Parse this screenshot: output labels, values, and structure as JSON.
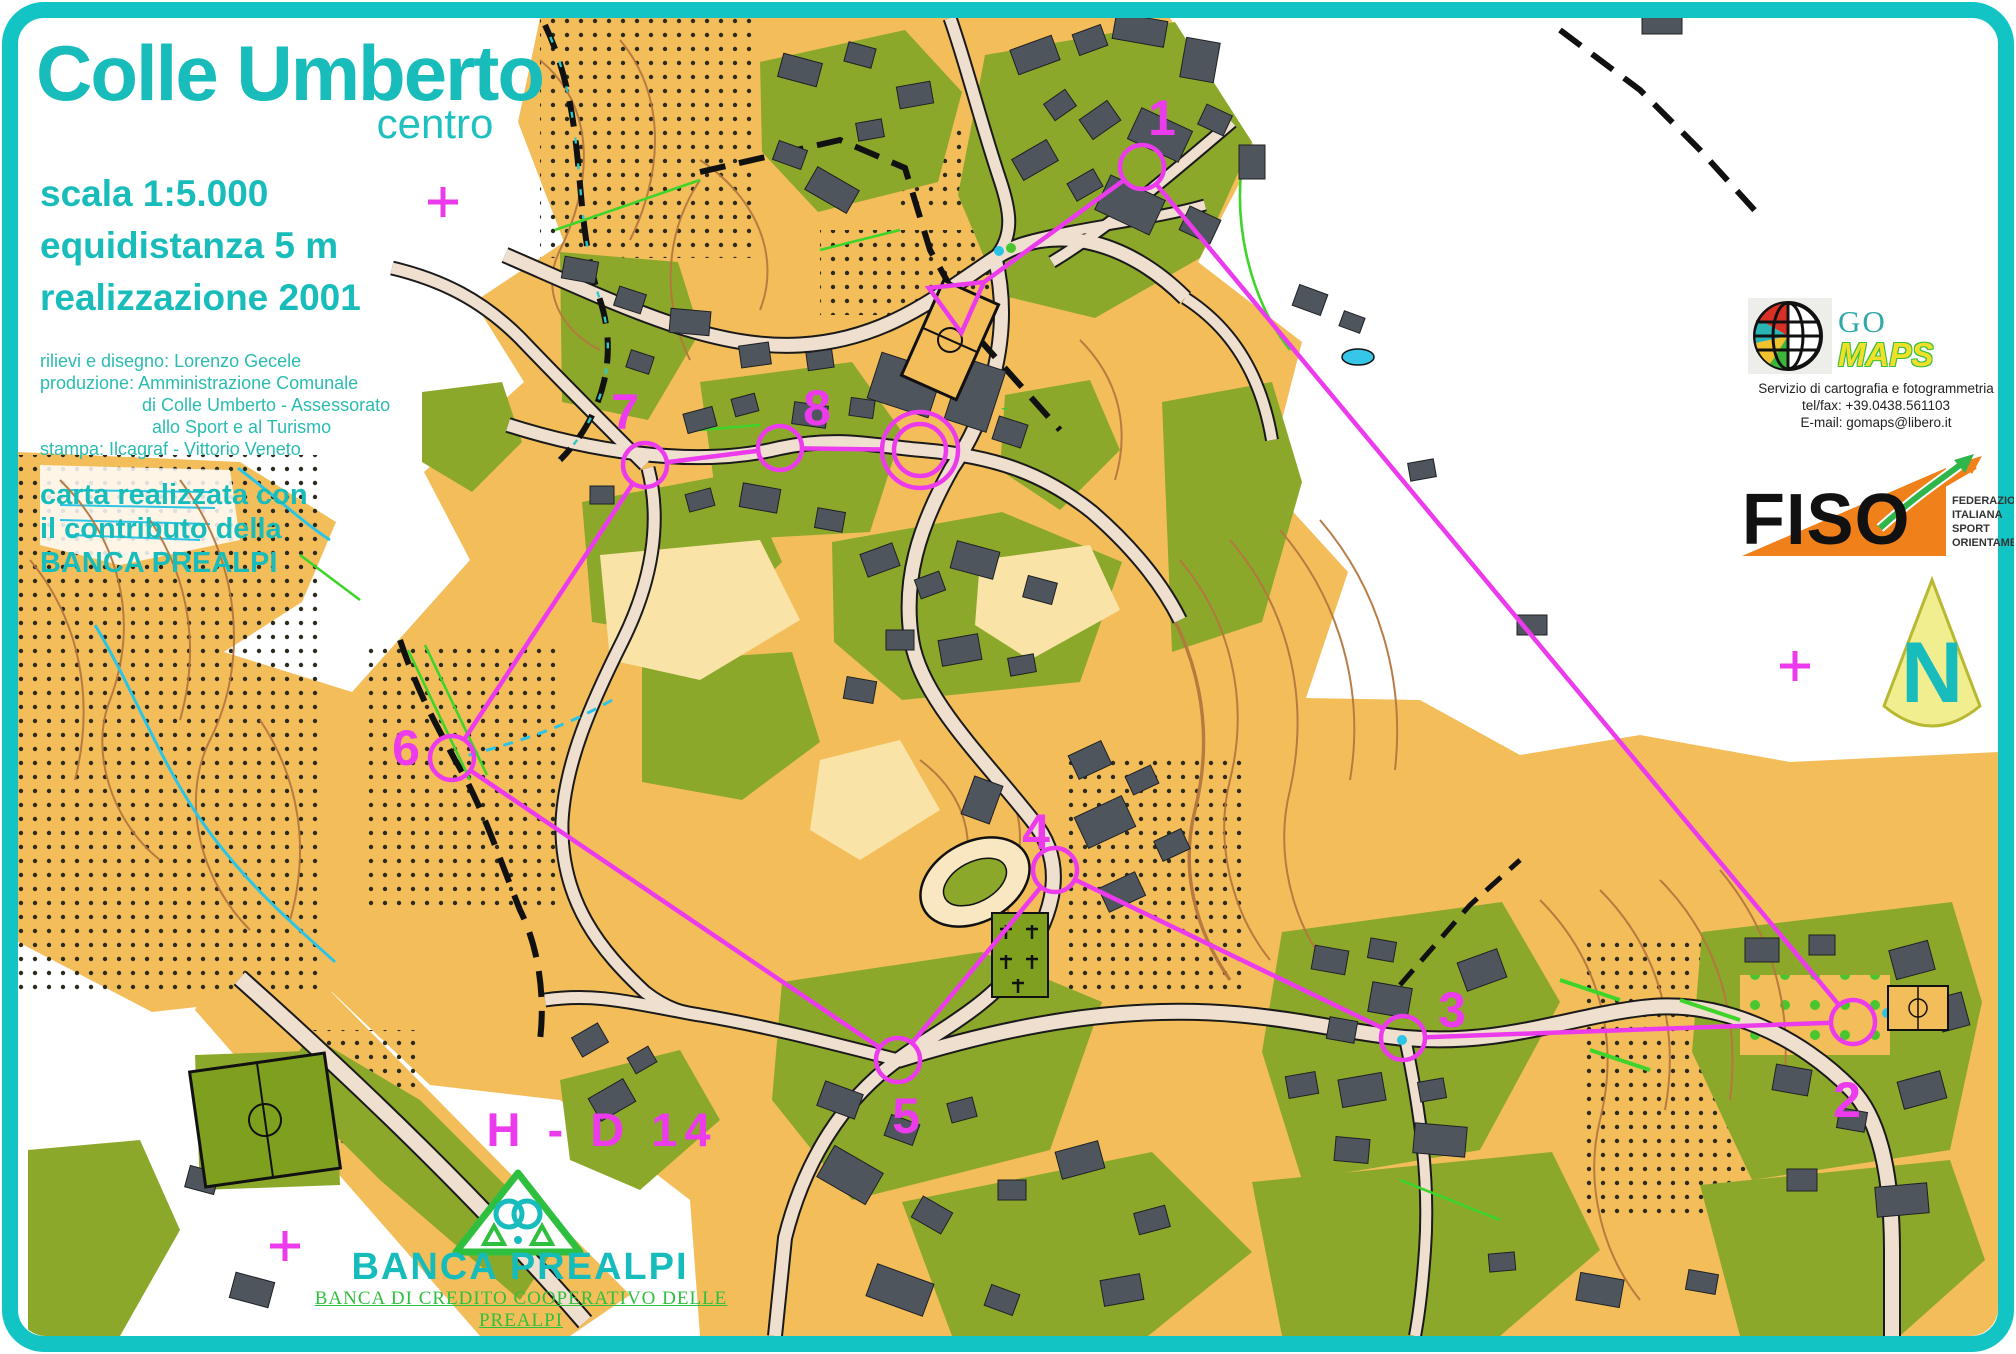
{
  "map": {
    "title": "Colle Umberto",
    "subtitle": "centro",
    "scale_lines": [
      "scala 1:5.000",
      "equidistanza 5 m",
      "realizzazione 2001"
    ],
    "credits": [
      "rilievi e disegno: Lorenzo Gecele",
      "produzione: Amministrazione Comunale",
      "di Colle Umberto - Assessorato",
      "allo Sport e al Turismo",
      "stampa: Ilcagraf - Vittorio Veneto"
    ],
    "contribution": [
      "carta realizzata con",
      "il contributo della",
      "BANCA PREALPI"
    ],
    "north_label": "N"
  },
  "course": {
    "label": "H - D 14",
    "color": "#EC3BEC",
    "circle_radius": 22,
    "line_width": 4.5,
    "start": {
      "x": 958,
      "y": 301,
      "trim": 32
    },
    "finish": {
      "x": 920,
      "y": 450,
      "r_outer": 38,
      "r_inner": 26
    },
    "controls": [
      {
        "n": "1",
        "x": 1142,
        "y": 167,
        "lx": 1162,
        "ly": 118
      },
      {
        "n": "2",
        "x": 1853,
        "y": 1022,
        "lx": 1847,
        "ly": 1100
      },
      {
        "n": "3",
        "x": 1403,
        "y": 1038,
        "lx": 1452,
        "ly": 1010
      },
      {
        "n": "4",
        "x": 1055,
        "y": 870,
        "lx": 1036,
        "ly": 832
      },
      {
        "n": "5",
        "x": 898,
        "y": 1060,
        "lx": 906,
        "ly": 1116
      },
      {
        "n": "6",
        "x": 452,
        "y": 758,
        "lx": 406,
        "ly": 748
      },
      {
        "n": "7",
        "x": 645,
        "y": 465,
        "lx": 625,
        "ly": 412
      },
      {
        "n": "8",
        "x": 780,
        "y": 448,
        "lx": 817,
        "ly": 408
      }
    ],
    "crosses": [
      {
        "x": 443,
        "y": 202
      },
      {
        "x": 1795,
        "y": 666
      },
      {
        "x": 285,
        "y": 1246
      }
    ]
  },
  "logos": {
    "gomaps": {
      "word1": "GO",
      "word2": "MAPS",
      "sub": [
        "Servizio di cartografia e fotogrammetria",
        "tel/fax: +39.0438.561103",
        "E-mail: gomaps@libero.it"
      ]
    },
    "fiso": {
      "name": "FISO",
      "sub": [
        "FEDERAZIONE",
        "ITALIANA",
        "SPORT",
        "ORIENTAMENTO"
      ]
    },
    "banca": {
      "name": "BANCA PREALPI",
      "sub": "BANCA DI CREDITO COOPERATIVO DELLE PREALPI"
    }
  },
  "colors": {
    "title_teal": "#18BCBA",
    "course_magenta": "#EC3BEC",
    "terrain_orange": "#F3BE5A",
    "vegetation_olive": "#8CA82B",
    "border_teal": "#12C4C4",
    "banca_green": "#2FBF3F"
  }
}
